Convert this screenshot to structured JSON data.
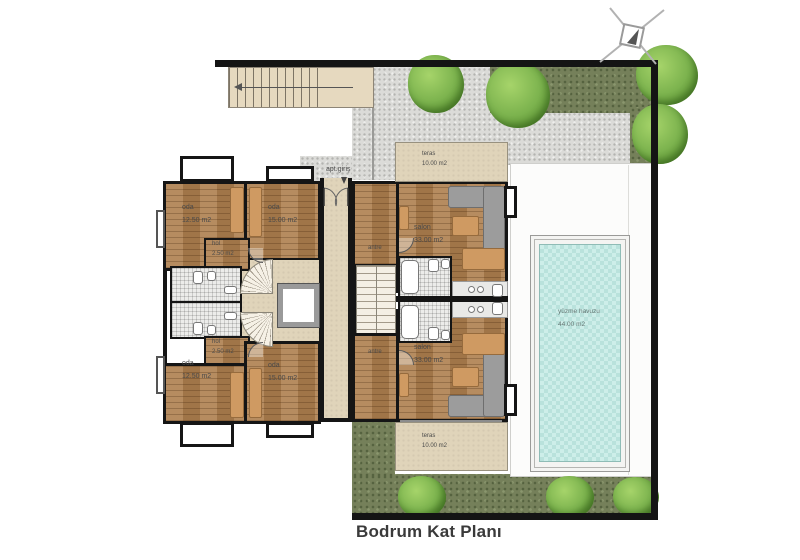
{
  "title": "Bodrum Kat Planı",
  "site": {
    "entry_label": "apt.giriş",
    "icons": {
      "north_arrow": "crossed-lines-compass",
      "entry_direction": "down-arrow",
      "stair_direction": "left-arrow"
    }
  },
  "rooms": {
    "teras_top": {
      "name": "teras",
      "area": "10.00 m2"
    },
    "teras_bottom": {
      "name": "teras",
      "area": "10.00 m2"
    },
    "oda_top_left": {
      "name": "oda",
      "area": "12.50 m2"
    },
    "oda_top_right": {
      "name": "oda",
      "area": "15.00 m2"
    },
    "oda_bottom_left": {
      "name": "oda",
      "area": "12.50 m2"
    },
    "oda_bottom_right": {
      "name": "oda",
      "area": "15.00 m2"
    },
    "hol_top": {
      "name": "hol",
      "area": "2.50 m2"
    },
    "hol_bottom": {
      "name": "hol",
      "area": "2.50 m2"
    },
    "antre_top": {
      "name": "antre"
    },
    "antre_bottom": {
      "name": "antre"
    },
    "salon_top": {
      "name": "salon",
      "area": "33.00 m2"
    },
    "salon_bottom": {
      "name": "salon",
      "area": "33.00 m2"
    },
    "pool": {
      "name": "yüzme havuzu",
      "area": "44.00 m2"
    }
  },
  "colors": {
    "wall": "#151515",
    "wood_floor": "#ae7f4e",
    "bath_tile": "#ececea",
    "terrace": "#e0d4ba",
    "gravel": "#dbdbd8",
    "grass": "#75805a",
    "tree": "#7cb34e",
    "pool_water": "#cdeee9",
    "pool_deck": "#fcfcfb",
    "sofa": "#9c9c9c",
    "furniture_wood": "#cf9a62"
  }
}
